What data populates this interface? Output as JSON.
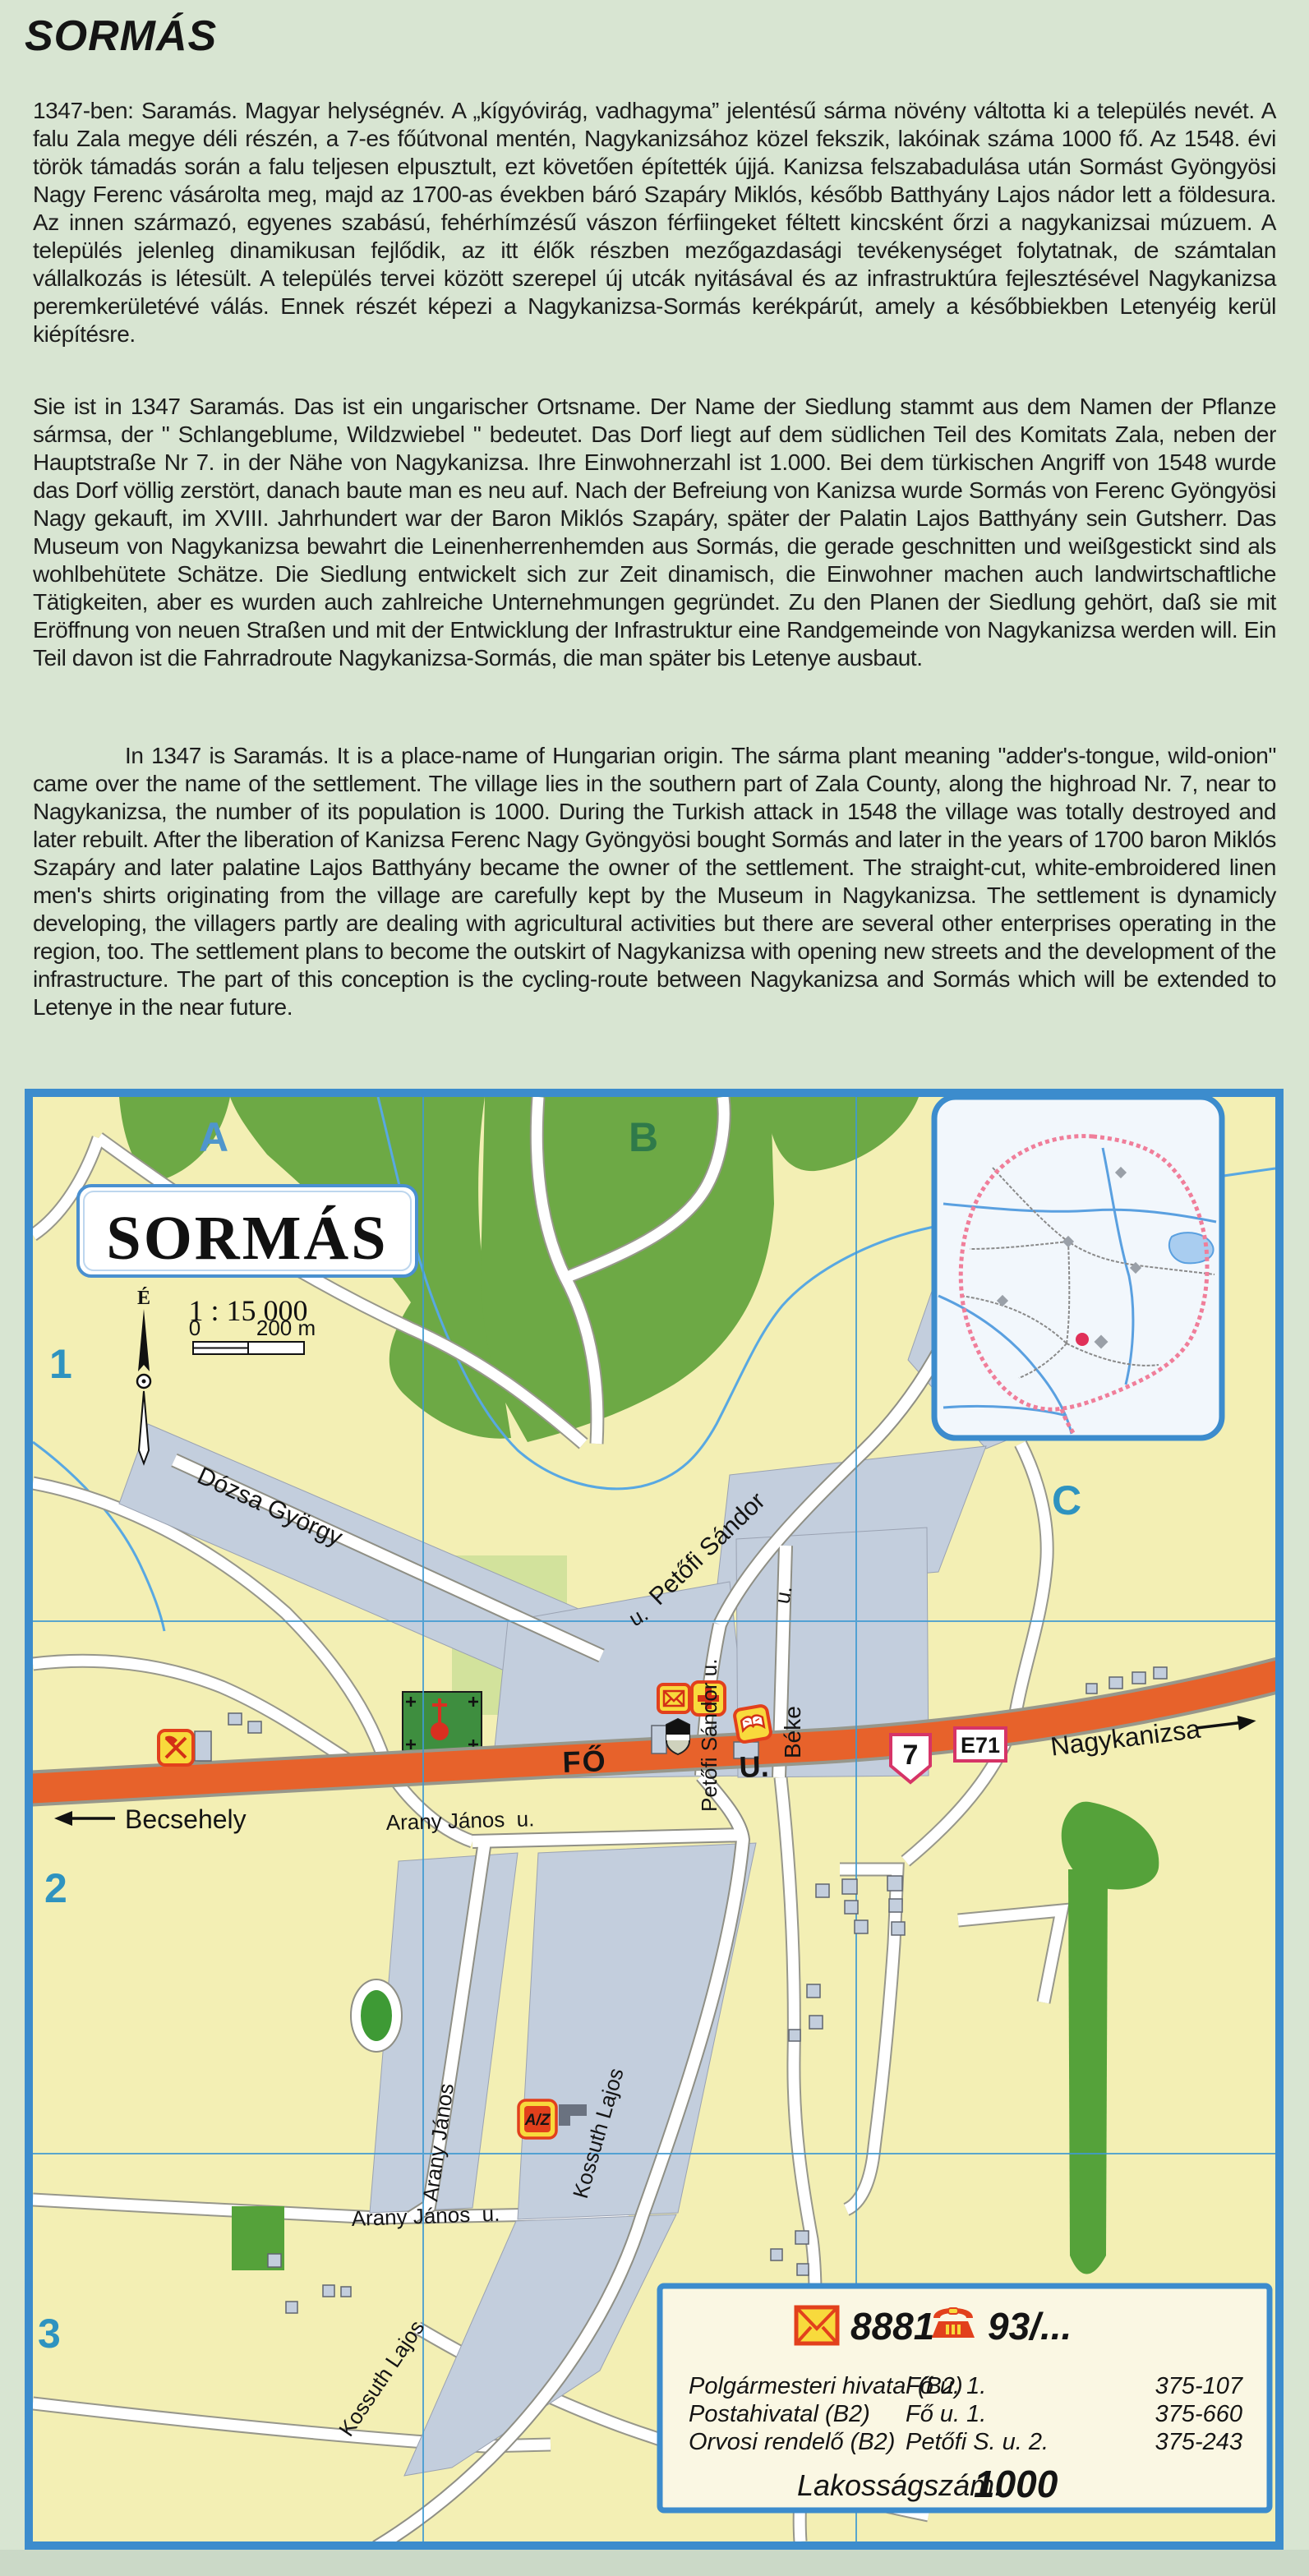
{
  "page": {
    "title": "SORMÁS",
    "paragraphs": {
      "hungarian": "1347-ben: Saramás. Magyar helységnév. A „kígyóvirág, vadhagyma” jelentésű sárma növény váltotta ki a település nevét. A falu Zala megye déli részén, a 7-es főútvonal mentén, Nagykanizsához közel fekszik, lakóinak száma 1000 fő. Az 1548. évi török támadás során a falu teljesen elpusztult, ezt követően építették újjá. Kanizsa felszabadulása után Sormást Gyöngyösi Nagy Ferenc vásárolta meg, majd az 1700-as években báró Szapáry Miklós, később Batthyány Lajos nádor lett a földesura. Az innen származó, egyenes szabású, fehérhímzésű vászon férfiingeket féltett kincsként őrzi a nagykanizsai múzuem. A település jelenleg dinamikusan fejlődik, az itt élők részben mezőgazdasági tevékenységet folytatnak, de számtalan vállalkozás is létesült.  A település tervei között szerepel új utcák nyitásával és az infrastruktúra fejlesztésével Nagykanizsa peremkerületévé válás. Ennek részét képezi a Nagykanizsa-Sormás kerékpárút, amely a későbbiekben Letenyéig kerül kiépítésre.",
      "german": "Sie ist in 1347 Saramás. Das ist ein ungarischer Ortsname. Der Name der Siedlung stammt aus dem Namen der Pflanze sármsa, der \" Schlangeblume, Wildzwiebel \" bedeutet. Das Dorf liegt auf dem südlichen Teil des Komitats Zala, neben der Hauptstraße Nr 7. in der Nähe von Nagykanizsa. Ihre Einwohnerzahl ist 1.000. Bei dem türkischen Angriff von 1548 wurde das Dorf völlig zerstört, danach baute man es neu auf. Nach der Befreiung von Kanizsa wurde Sormás von Ferenc Gyöngyösi Nagy gekauft, im XVIII. Jahrhundert war der Baron Miklós Szapáry, später der Palatin Lajos Batthyány sein Gutsherr. Das Museum von Nagykanizsa bewahrt die Leinenherrenhemden aus Sormás, die gerade geschnitten und weißgestickt sind als  wohlbehütete Schätze. Die Siedlung entwickelt sich zur Zeit dinamisch, die Einwohner machen auch landwirtschaftliche Tätigkeiten, aber es wurden auch zahlreiche Unternehmungen gegründet. Zu den Planen der Siedlung gehört, daß sie mit Eröffnung von neuen Straßen und mit der Entwicklung der Infrastruktur eine Randgemeinde von Nagykanizsa werden will. Ein Teil davon ist die Fahrradroute Nagykanizsa-Sormás, die man später bis Letenye ausbaut.",
      "english": "In 1347 is Saramás. It is a place-name of Hungarian origin. The sárma plant meaning \"adder's-tongue, wild-onion\" came over the name of the settlement. The village lies in the southern part of Zala County, along the highroad Nr. 7, near to Nagykanizsa, the number of its population is 1000. During the Turkish attack in 1548 the village was totally destroyed and later rebuilt. After the liberation of Kanizsa Ferenc Nagy Gyöngyösi bought Sormás and later in the years of 1700 baron Miklós Szapáry and later palatine Lajos Batthyány became the owner of the settlement. The straight-cut, white-embroidered linen men's shirts originating from the village are carefully kept by the Museum in Nagykanizsa. The settlement is dynamicly developing, the villagers partly are dealing with agricultural activities but there are several other enterprises operating in the region, too. The settlement plans to become the outskirt of Nagykanizsa with opening new streets and the development of the infrastructure. The part of this conception is the cycling-route between Nagykanizsa and Sormás which will be extended to Letenye in the near future."
    }
  },
  "map": {
    "title": "SORMÁS",
    "scale": {
      "ratio": "1 : 15 000",
      "zero": "0",
      "end": "200 m"
    },
    "compass_north": "É",
    "grid": {
      "col_a": "A",
      "col_b": "B",
      "col_c": "C",
      "row_1": "1",
      "row_2": "2",
      "row_3": "3"
    },
    "signs": {
      "route": "7",
      "euro_route": "E71"
    },
    "directions": {
      "west": "Becsehely",
      "east": "Nagykanizsa"
    },
    "streets": {
      "dozsa": "Dózsa György",
      "petofi_diagonal": "Petőfi Sándor",
      "petofi_vertical": "Petőfi Sándor u.",
      "u_abbrev": "u.",
      "beke": "Béke",
      "fo": "FŐ",
      "fo_u": "U.",
      "arany": "Arany János",
      "arany_u": "Arany János  u.",
      "kossuth": "Kossuth Lajos"
    },
    "az_label": "A/Z",
    "accent_colors": {
      "frame_blue": "#3c8ccd",
      "road_orange": "#e7622b",
      "sign_crimson": "#d63467",
      "icon_yellow": "#f8da3c",
      "icon_red": "#e2401c"
    }
  },
  "info_box": {
    "postal_code": "8881",
    "phone_prefix": "93/...",
    "rows": [
      {
        "name": "Polgármesteri hivatal (B2)",
        "address": "Fő u. 1.",
        "phone": "375-107"
      },
      {
        "name": "Postahivatal (B2)",
        "address": "Fő u. 1.",
        "phone": "375-660"
      },
      {
        "name": "Orvosi rendelő (B2)",
        "address": "Petőfi S. u. 2.",
        "phone": "375-243"
      }
    ],
    "population_label": "Lakosságszám:",
    "population_value": "1000"
  }
}
